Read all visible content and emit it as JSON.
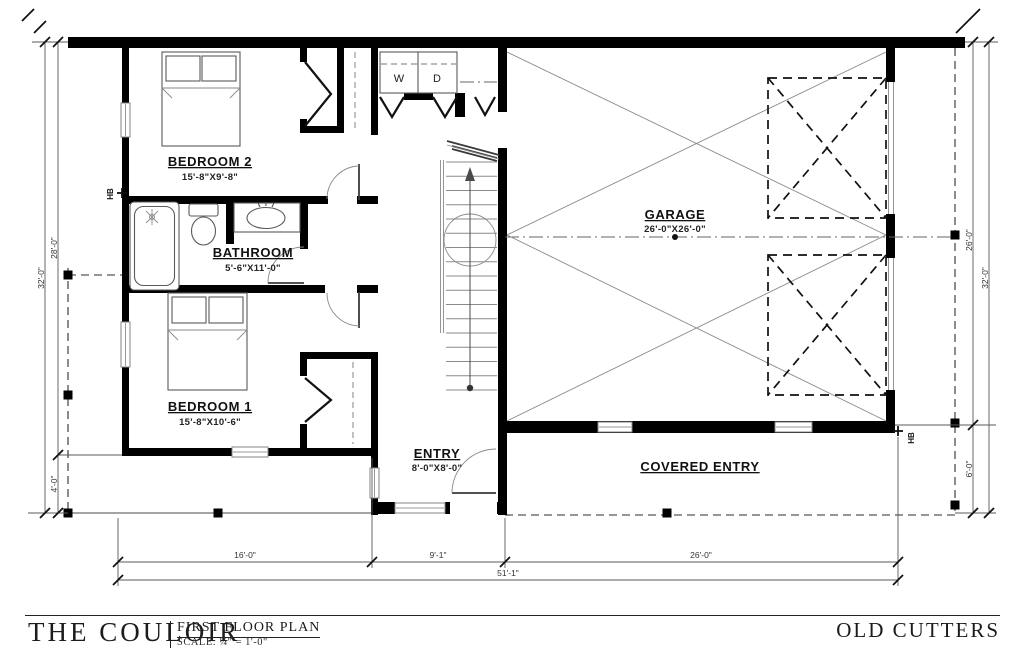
{
  "drawing": {
    "rooms": {
      "bedroom2": {
        "name": "BEDROOM 2",
        "dims": "15'-8\"X9'-8\""
      },
      "bathroom": {
        "name": "BATHROOM",
        "dims": "5'-6\"X11'-0\""
      },
      "bedroom1": {
        "name": "BEDROOM 1",
        "dims": "15'-8\"X10'-6\""
      },
      "garage": {
        "name": "GARAGE",
        "dims": "26'-0\"X26'-0\""
      },
      "entry": {
        "name": "ENTRY",
        "dims": "8'-0\"X8'-0\""
      },
      "covered_entry": {
        "name": "COVERED ENTRY"
      }
    },
    "appliances": {
      "washer": "W",
      "dryer": "D"
    },
    "plumbing": {
      "hose_bib_left": "HB",
      "hose_bib_right": "HB"
    },
    "dimensions": {
      "left_overall": "32'-0\"",
      "left_main": "28'-0\"",
      "left_porch": "4'-0\"",
      "right_overall": "32'-0\"",
      "right_garage": "26'-0\"",
      "right_porch": "6'-0\"",
      "bottom_bedroom_wing": "16'-0\"",
      "bottom_entry": "9'-1\"",
      "bottom_garage": "26'-0\"",
      "bottom_overall": "51'-1\""
    }
  },
  "title_block": {
    "project_name": "THE COULOIR",
    "sheet_title": "FIRST FLOOR PLAN",
    "scale_note": "SCALE: ¼\" = 1'-0\"",
    "development_name": "OLD CUTTERS"
  },
  "colors": {
    "wall": "#000000",
    "line": "#555555",
    "window": "#888888",
    "text": "#111111",
    "background": "#ffffff"
  }
}
